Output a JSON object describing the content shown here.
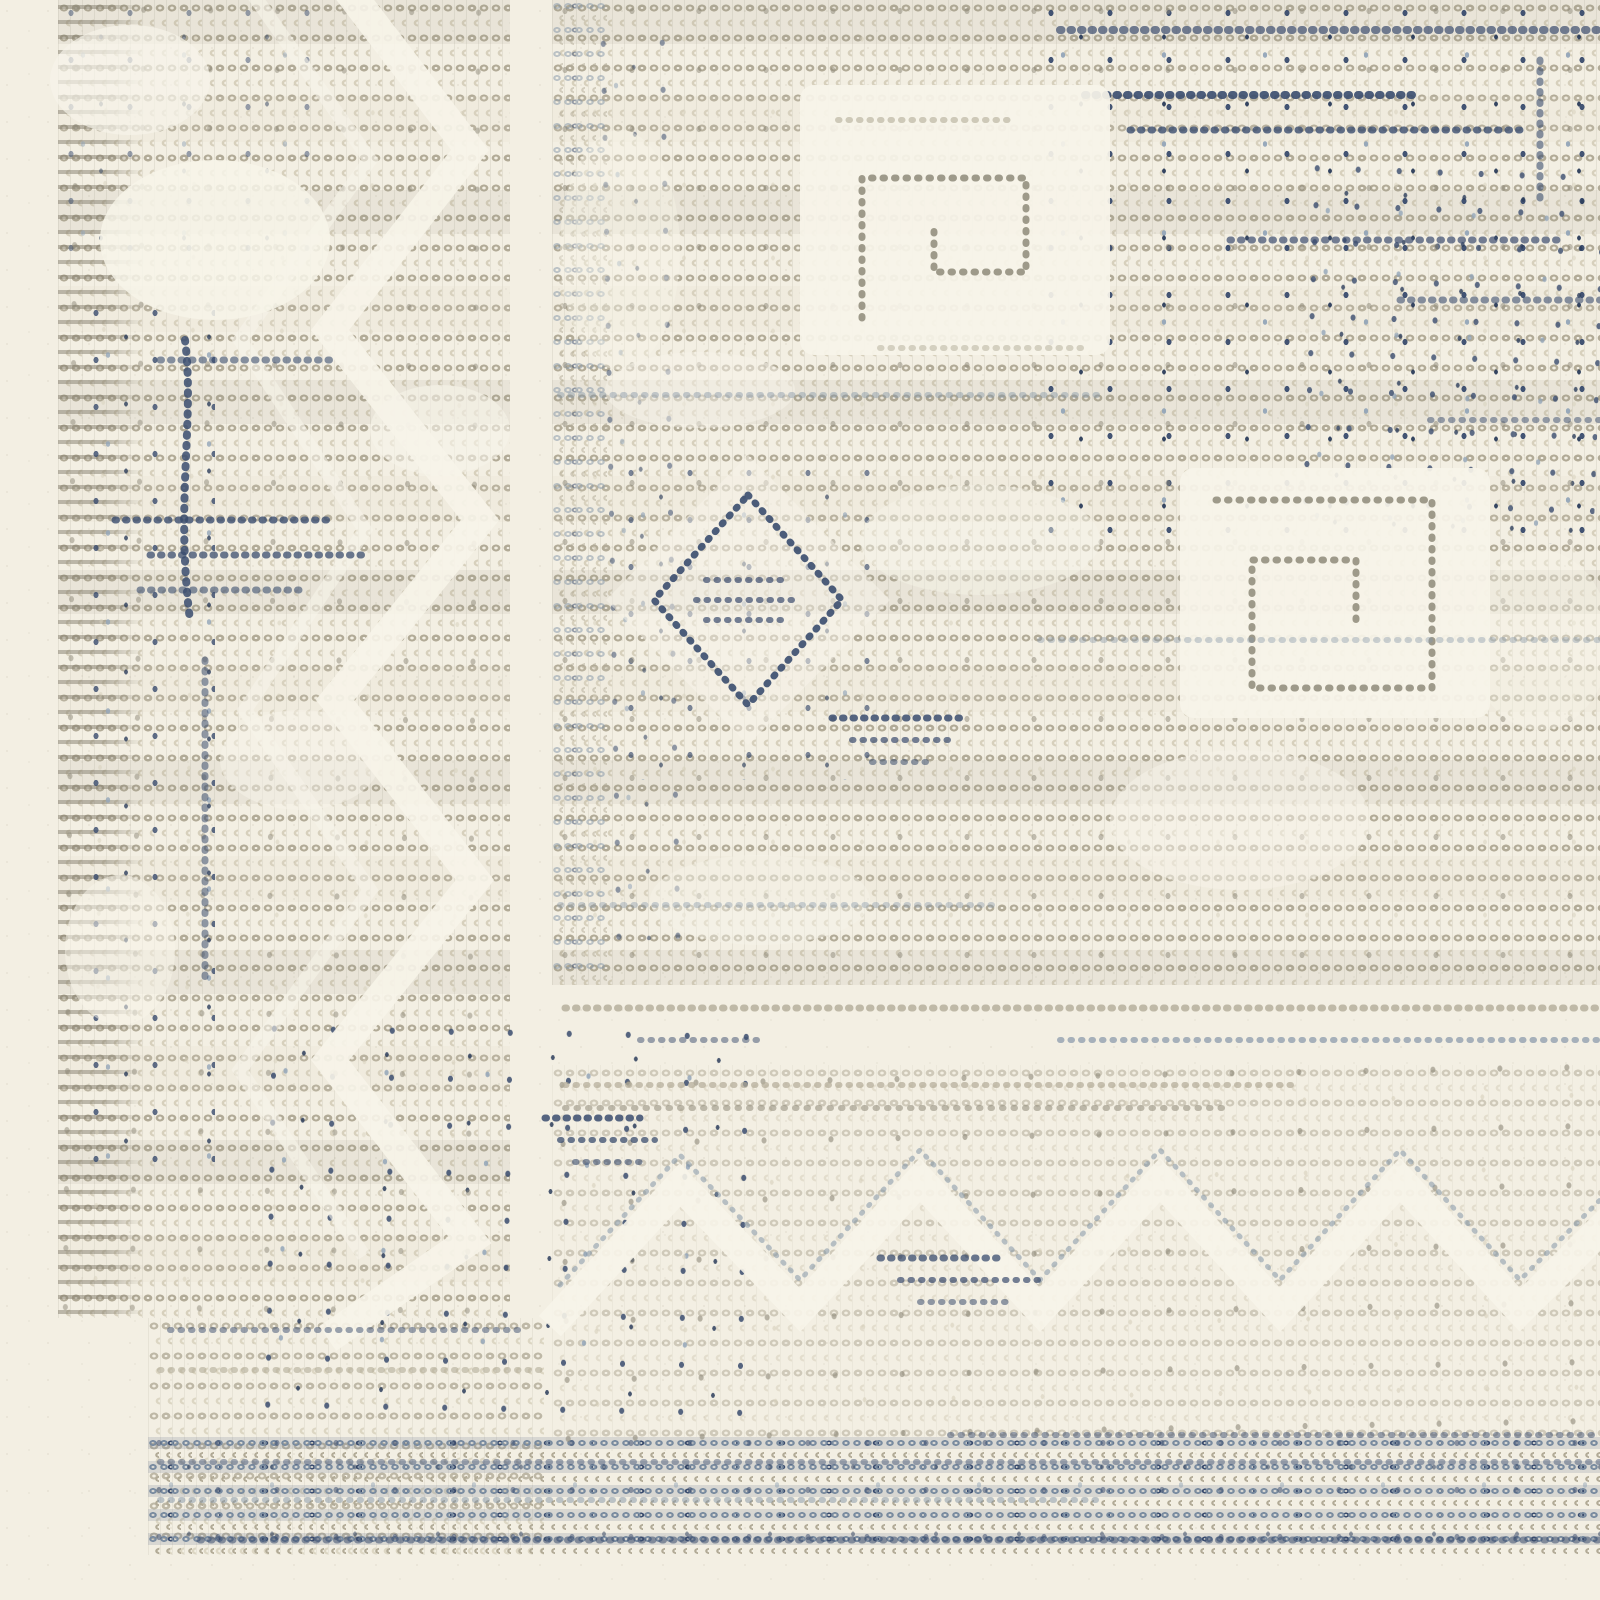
{
  "image": {
    "type": "photograph",
    "subject": "Close-up corner detail of a handwoven ivory flatweave rug",
    "description": "Ivory wool rug woven in rows of small oval stitches. A wide left border band with zigzag motifs and indigo flecks, a dense main field with Greek-key hook panels and a diamond medallion outlined in indigo dots, a plain-weave break, a sparse lower band with zigzag triangles, and dense blue-grey stitch stripes along the bottom edge with plain cream selvage margins."
  },
  "palette": {
    "cream": "#f3efe3",
    "cream-bright": "#f7f4e9",
    "stitch-light": "#d7d0bc",
    "stitch-mid": "#b2ab97",
    "stitch-dark": "#8e8979",
    "stitch-slate": "#8496a8",
    "navy": "#3a4c6e",
    "navy-deep": "#2c3d5b",
    "blue-soft": "#94a6b9"
  },
  "regions": {
    "left_selvage": "plain cream selvage edge",
    "left_border_band": "dotted border band, zigzag motifs, indigo flecks",
    "main_field": "dense stitch field with Greek-key hook panels and diamond medallion",
    "weave_break": "plain horizontal break between field and lower border",
    "lower_border": "sparse stitch band with zigzag triangle motifs",
    "bottom_stripe": "dense blue-grey stitch rows",
    "bottom_selvage": "plain cream bottom edge"
  },
  "motifs": [
    "greek-key-hooks",
    "diamond-medallion",
    "zigzag-triangles",
    "indigo-flecks",
    "stitch-rows"
  ]
}
